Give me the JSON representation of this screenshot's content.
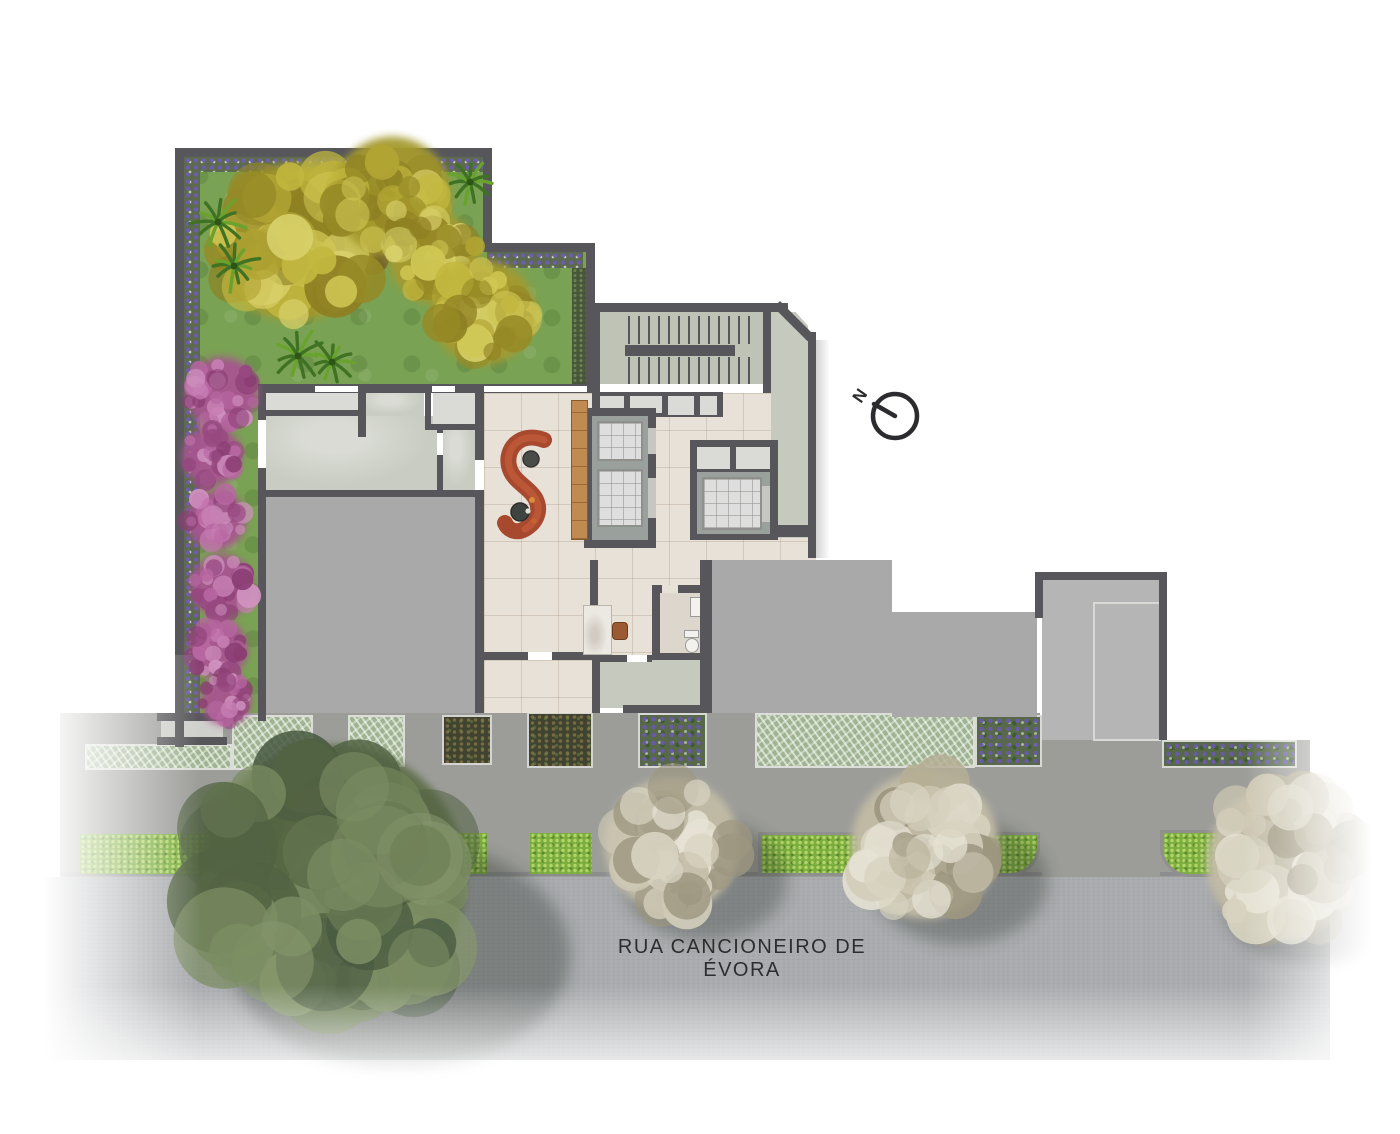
{
  "labels": {
    "street_name": "RUA CANCIONEIRO DE ÉVORA",
    "north": "N"
  },
  "palette": {
    "wall": "#57575b",
    "garden_grass": "#7aa254",
    "lobby_floor": "#e8e1d7",
    "concrete_floor": "#c9ccc2",
    "building_mass": "#a9a9a9",
    "sidewalk": "#9c9d99",
    "street": "#a9abae",
    "hedge": "#7cae3f",
    "silver_foliage_bed": "#9fb392",
    "purple_flower_bed": "#57694a",
    "sofa_terracotta": "#a7492f",
    "wood_bench": "#c08a50",
    "pink_shrubs": "#a75590",
    "yellow_tree": "#b1a433",
    "olive_tree": "#5f7049",
    "beige_tree": "#c2bca6"
  }
}
